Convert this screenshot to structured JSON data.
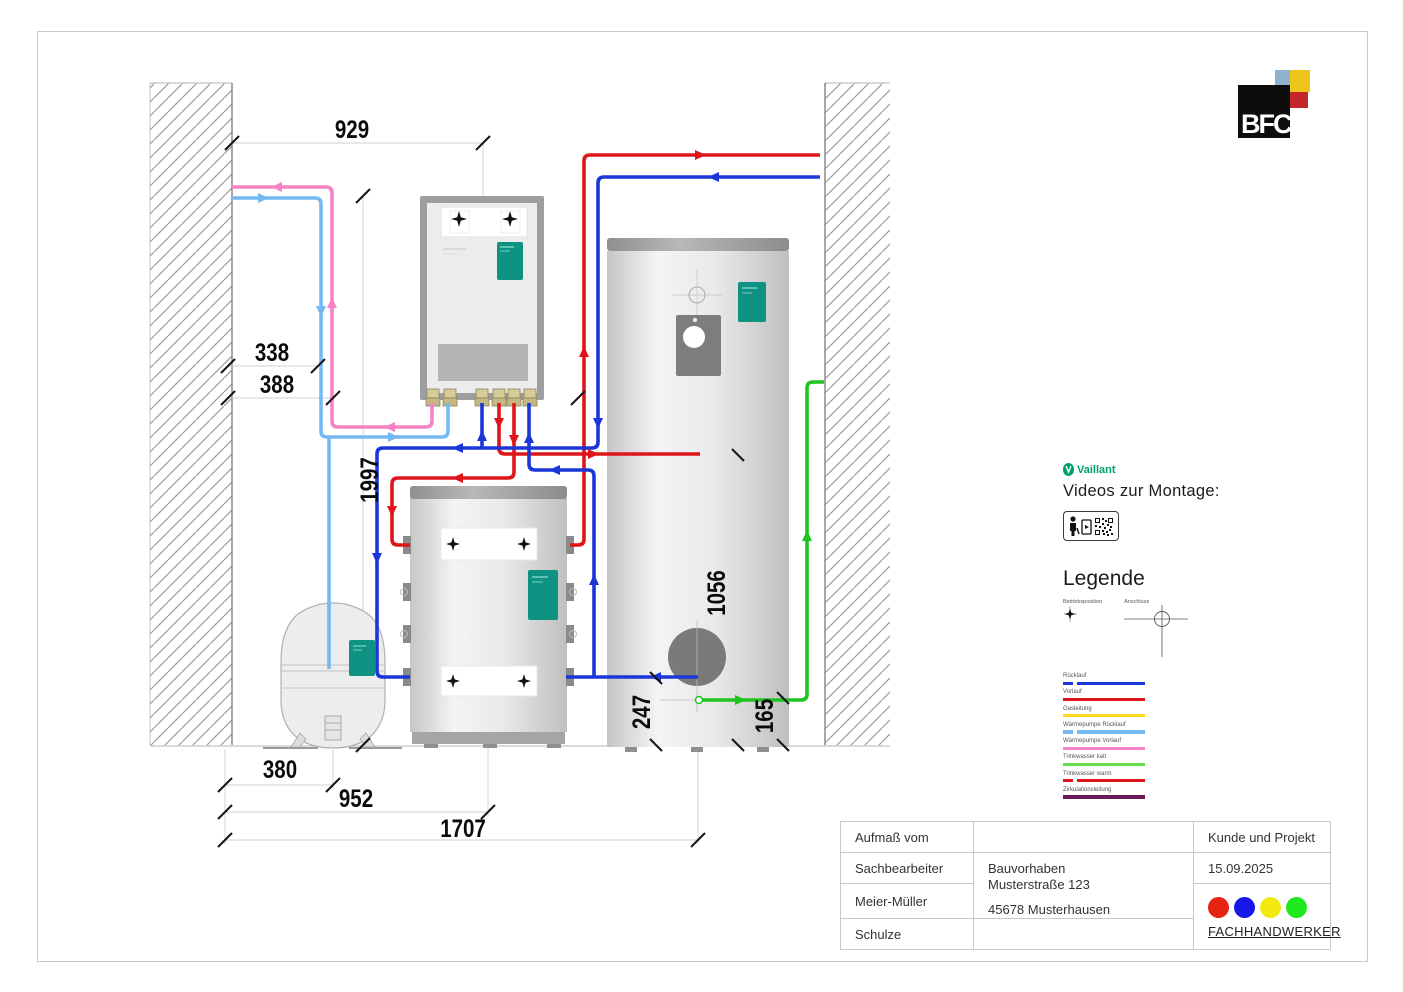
{
  "branding": {
    "bfc_logo_text": "BFC",
    "vaillant_logo_text": "Vaillant"
  },
  "right_panel": {
    "videos_heading": "Videos zur Montage:",
    "legend_title": "Legende",
    "position_symbol_label": "Betriebsposition",
    "connection_symbol_label": "Anschluss",
    "legend_items": [
      {
        "label": "Rücklauf",
        "color": "#1b36d9",
        "dashed_start": true
      },
      {
        "label": "Vorlauf",
        "color": "#e0151c",
        "dashed_start": false
      },
      {
        "label": "Gasleitung",
        "color": "#ffd81e",
        "dashed_start": false
      },
      {
        "label": "Wärmepumpe Rücklauf",
        "color": "#74b9f2",
        "dashed_start": true
      },
      {
        "label": "Wärmepumpe Vorlauf",
        "color": "#f583c5",
        "dashed_start": false
      },
      {
        "label": "Trinkwasser kalt",
        "color": "#64dd4a",
        "dashed_start": false
      },
      {
        "label": "Trinkwasser warm",
        "color": "#e0151c",
        "dashed_start": true
      },
      {
        "label": "Zirkulationsleitung",
        "color": "#6b1857",
        "dashed_start": false
      }
    ]
  },
  "dims": {
    "d929": "929",
    "d338": "338",
    "d388": "388",
    "d1997": "1997",
    "d1056": "1056",
    "d247": "247",
    "d165": "165",
    "d380": "380",
    "d952": "952",
    "d1707": "1707"
  },
  "title_block": {
    "aufmass_label": "Aufmaß vom",
    "sachbearbeiter_label": "Sachbearbeiter",
    "person1": "Meier-Müller",
    "person2": "Schulze",
    "project_line1": "Bauvorhaben",
    "project_line2": "Musterstraße 123",
    "project_line3": "45678 Musterhausen",
    "kunde_label": "Kunde und Projekt",
    "date": "15.09.2025",
    "fachhandwerker_label": "FACHHANDWERKER",
    "dot_colors": [
      "#e8230f",
      "#1717e8",
      "#f2ea0f",
      "#1ee81e"
    ]
  },
  "pipe_colors": {
    "vorlauf_red": "#e0151c",
    "ruecklauf_blue": "#1b36d9",
    "wp_vorlauf_pink": "#f583c5",
    "wp_ruecklauf_lightblue": "#74b9f2",
    "trinkwasser_kalt_green": "#1fc41f",
    "label_teal": "#0e9383"
  }
}
